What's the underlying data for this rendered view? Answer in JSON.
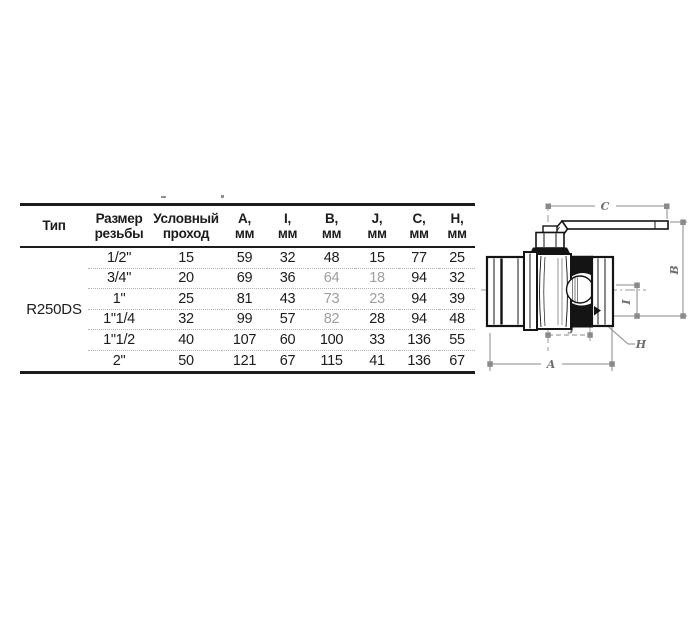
{
  "table": {
    "type_value": "R250DS",
    "headers": [
      {
        "line1": "Тип",
        "line2": ""
      },
      {
        "line1": "Размер",
        "line2": "резьбы"
      },
      {
        "line1": "Условный",
        "line2": "проход"
      },
      {
        "line1": "A,",
        "line2": "мм"
      },
      {
        "line1": "I,",
        "line2": "мм"
      },
      {
        "line1": "B,",
        "line2": "мм"
      },
      {
        "line1": "J,",
        "line2": "мм"
      },
      {
        "line1": "C,",
        "line2": "мм"
      },
      {
        "line1": "H,",
        "line2": "мм"
      }
    ],
    "rows": [
      {
        "cells": [
          "1/2\"",
          "15",
          "59",
          "32",
          "48",
          "15",
          "77",
          "25"
        ],
        "muted": []
      },
      {
        "cells": [
          "3/4\"",
          "20",
          "69",
          "36",
          "64",
          "18",
          "94",
          "32"
        ],
        "muted": [
          4,
          5
        ]
      },
      {
        "cells": [
          "1\"",
          "25",
          "81",
          "43",
          "73",
          "23",
          "94",
          "39"
        ],
        "muted": [
          4,
          5
        ]
      },
      {
        "cells": [
          "1\"1/4",
          "32",
          "99",
          "57",
          "82",
          "28",
          "94",
          "48"
        ],
        "muted": [
          4
        ]
      },
      {
        "cells": [
          "1\"1/2",
          "40",
          "107",
          "60",
          "100",
          "33",
          "136",
          "55"
        ],
        "muted": []
      },
      {
        "cells": [
          "2\"",
          "50",
          "121",
          "67",
          "115",
          "41",
          "136",
          "67"
        ],
        "muted": []
      }
    ]
  },
  "diagram": {
    "labels": {
      "A": "A",
      "B": "B",
      "C": "C",
      "H": "H",
      "I": "I",
      "J": "J"
    }
  },
  "colors": {
    "text": "#1c1c1c",
    "muted_text": "#9e9e9e",
    "dimension_lines": "#8a8a8a",
    "outline": "#141414",
    "background": "#ffffff"
  }
}
